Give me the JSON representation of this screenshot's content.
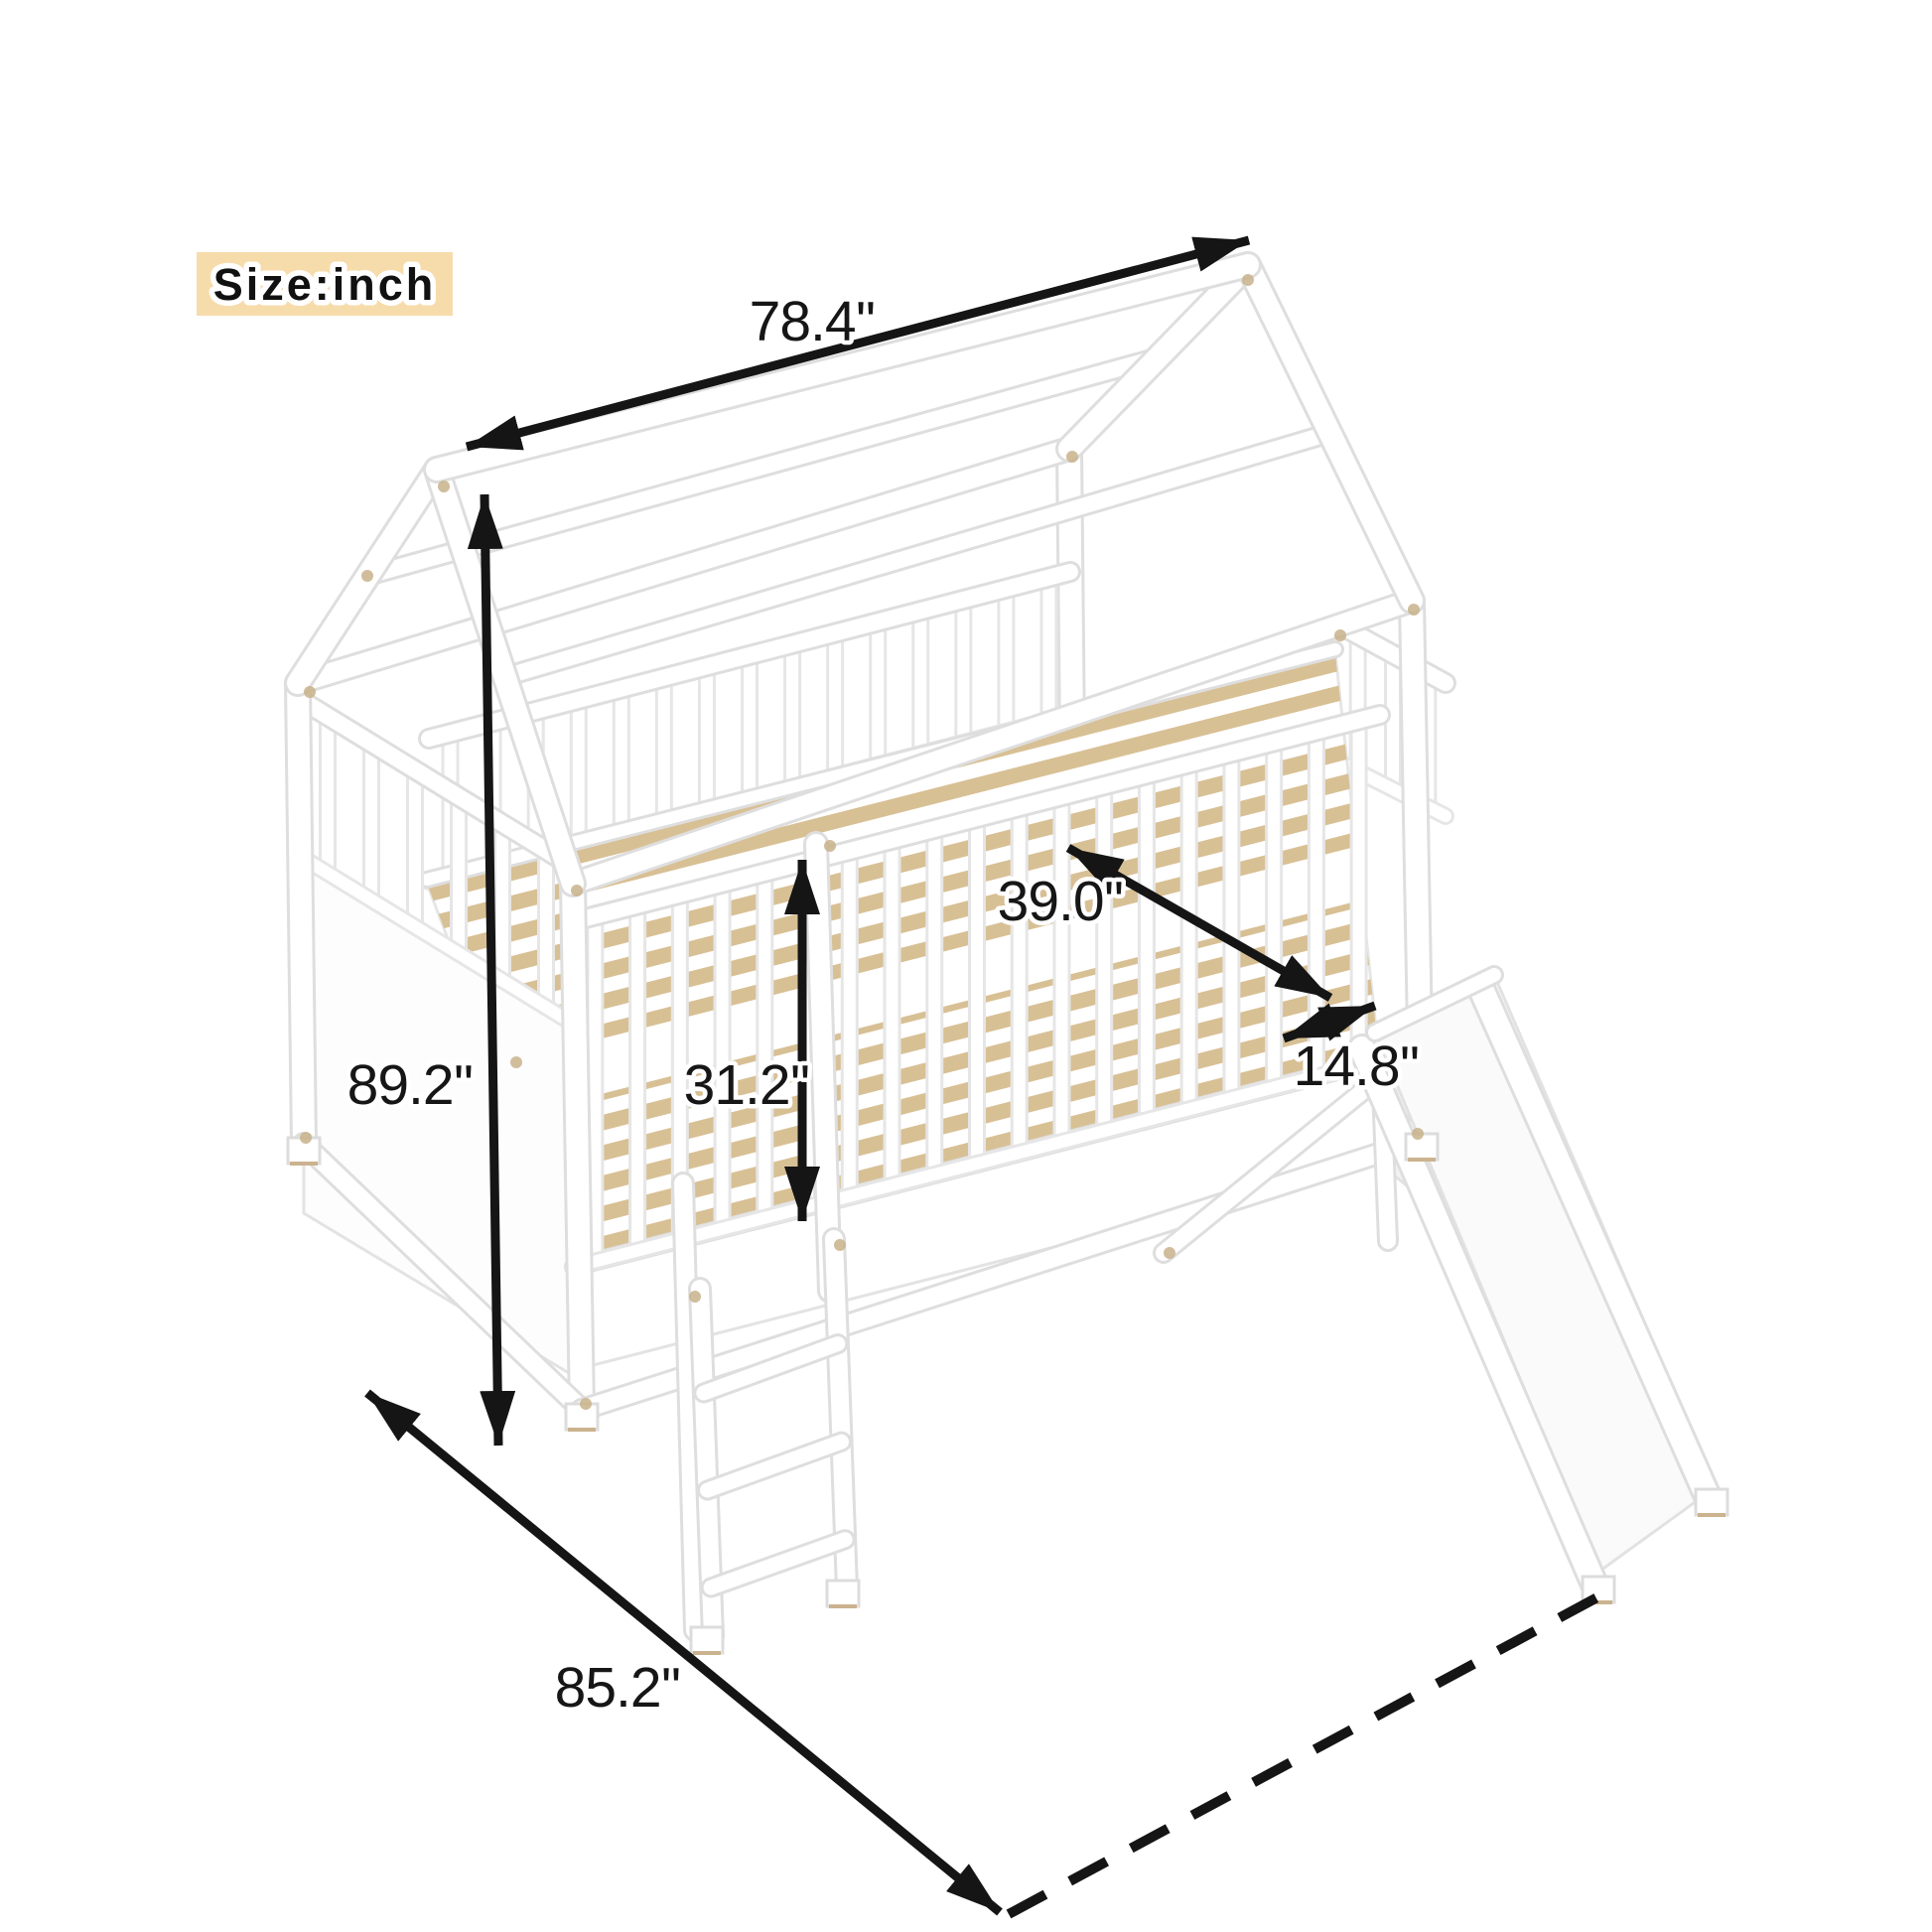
{
  "subject": "house-frame loft bed with guardrails, ladder and slide",
  "unit_badge": "Size:inch",
  "dimensions": {
    "roof_length": "78.4''",
    "overall_height": "89.2''",
    "bed_width": "39.0''",
    "guardrail_height": "31.2''",
    "slide_opening": "14.8''",
    "overall_depth": "85.2''"
  },
  "colors": {
    "badge_bg": "#f7dcab",
    "dimension_line": "#151515",
    "frame_edge": "#dedede",
    "slat_wood": "#d8c095",
    "screw_dot": "#c8b18a"
  }
}
